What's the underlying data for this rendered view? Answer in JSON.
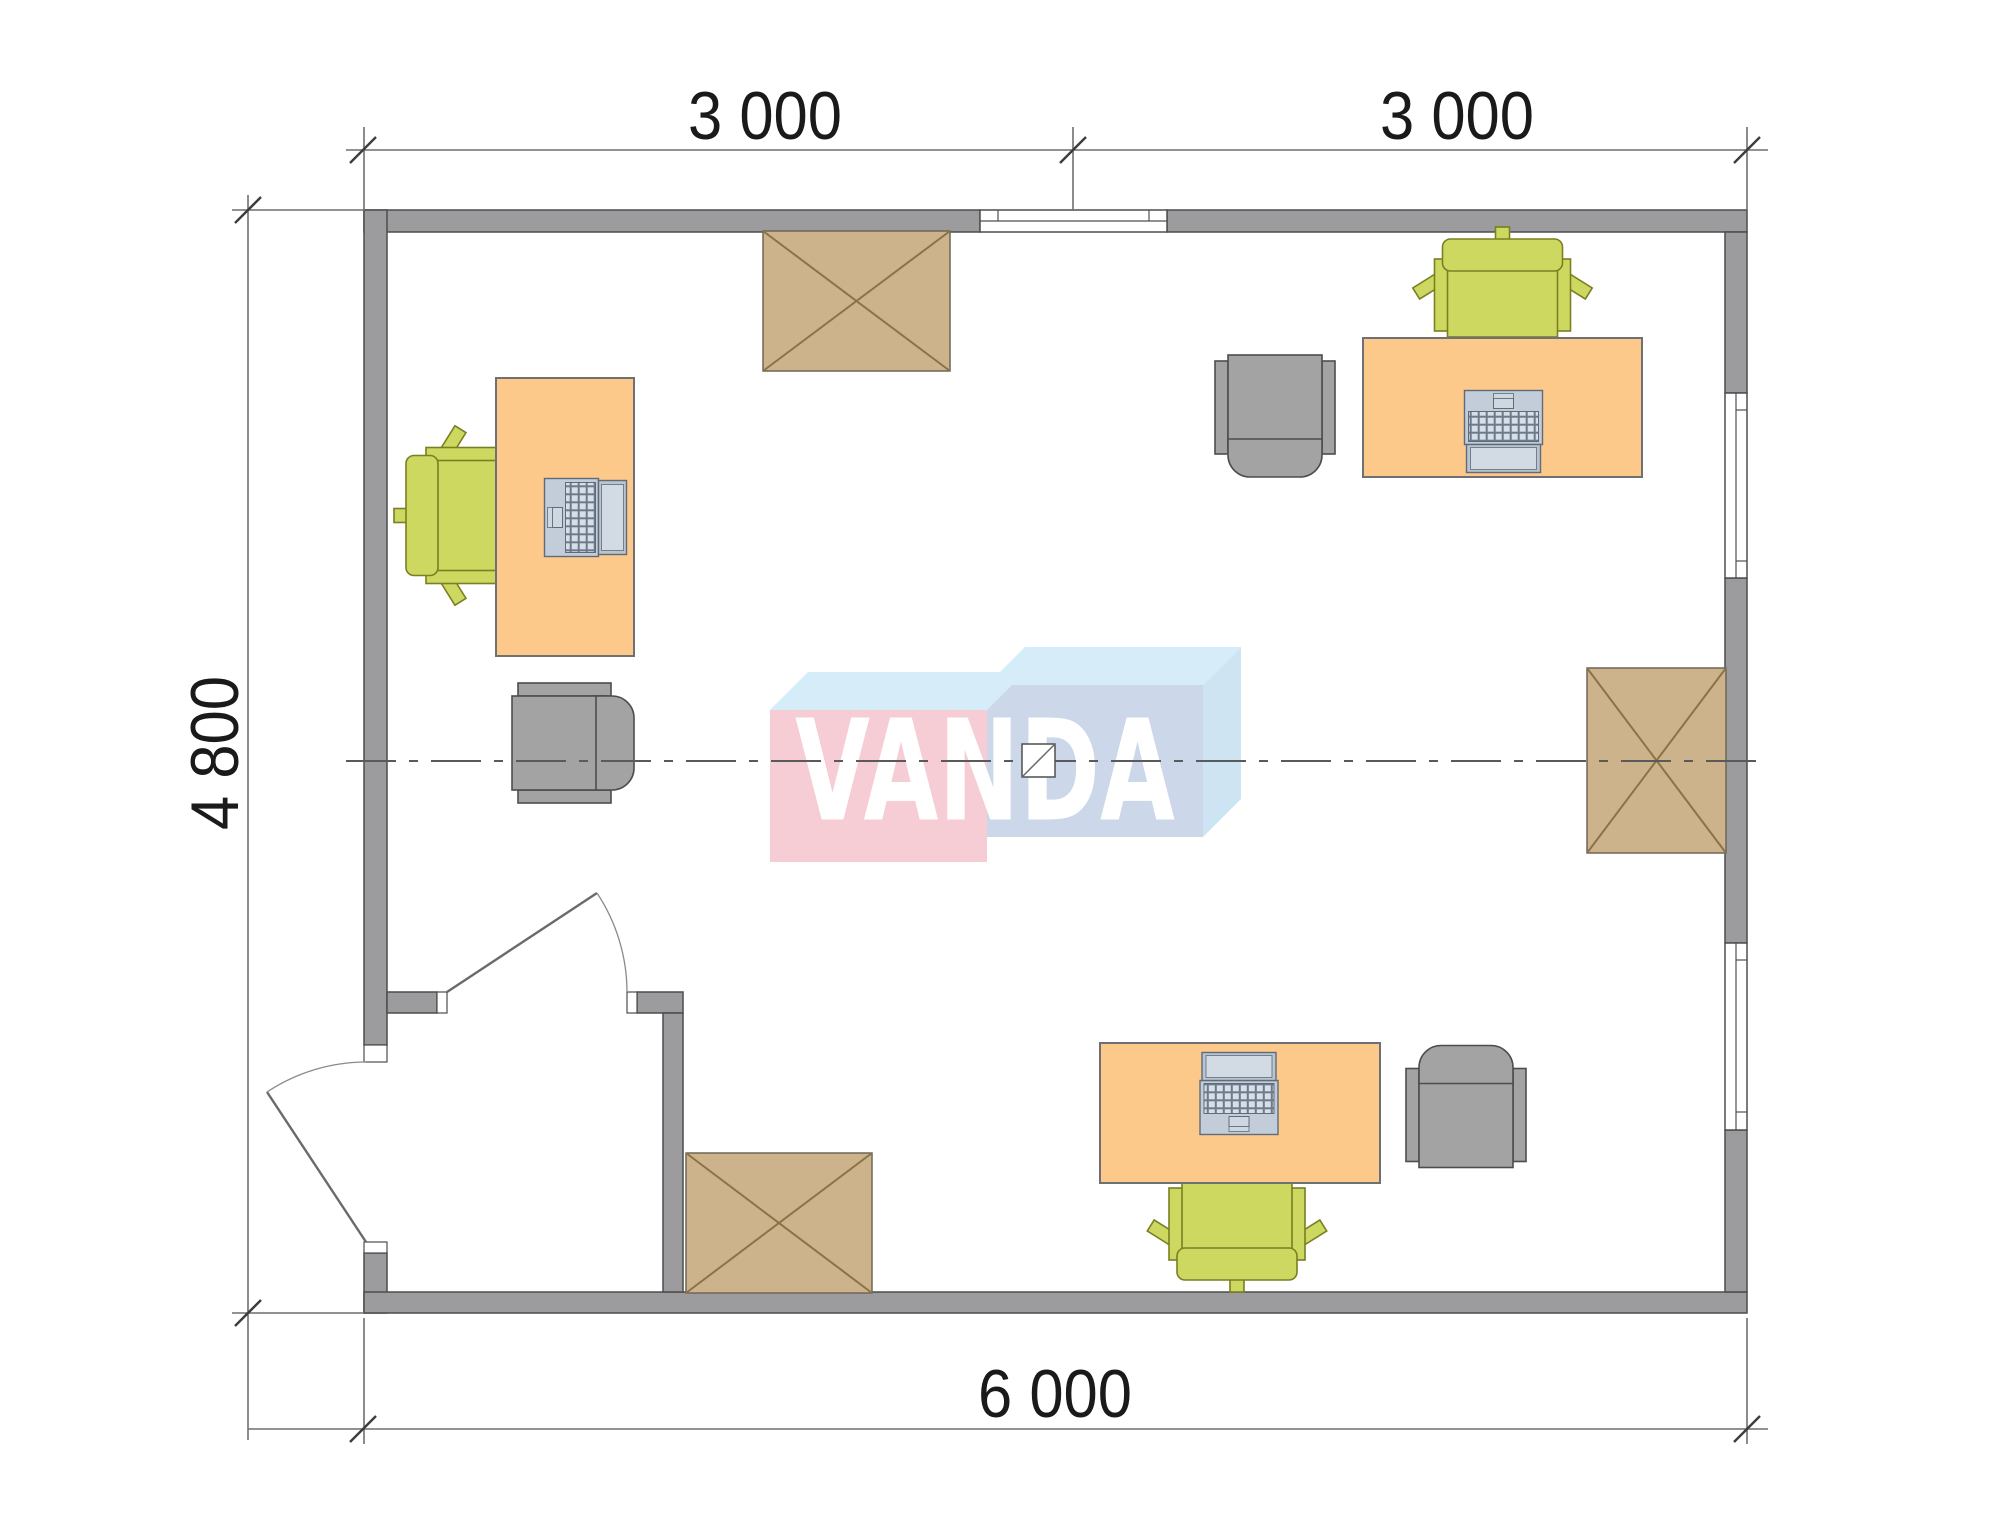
{
  "title": "Office floor plan 6000 x 4800",
  "dims": {
    "top_left": "3 000",
    "top_right": "3 000",
    "left": "4 800",
    "bottom": "6 000"
  },
  "watermark": {
    "text": "VANDA"
  },
  "colors": {
    "wall": "#9c9c9e",
    "wall_outline": "#4d4d4d",
    "desk": "#fcc98b",
    "desk_outline": "#6f7073",
    "office_chair": "#cdd860",
    "office_chair_outline": "#7a7f22",
    "armchair": "#a3a3a3",
    "armchair_outline": "#4d4d4d",
    "crossed_table": "#ccb38b",
    "crossed_table_lines": "#8b7348",
    "laptop_body": "#c3cdd9",
    "logo_pink": "#f6ccd5",
    "logo_blue_front": "#ccd8e9",
    "logo_blue_top": "#d6ecf8",
    "dimension_line": "#6f6f6f",
    "centerline": "#5a5a5a"
  },
  "plan_contents": {
    "desks": 3,
    "office_chairs": 3,
    "armchairs": 3,
    "crossed_tables": 3,
    "laptops": 3,
    "windows": 3,
    "doors": 2
  }
}
